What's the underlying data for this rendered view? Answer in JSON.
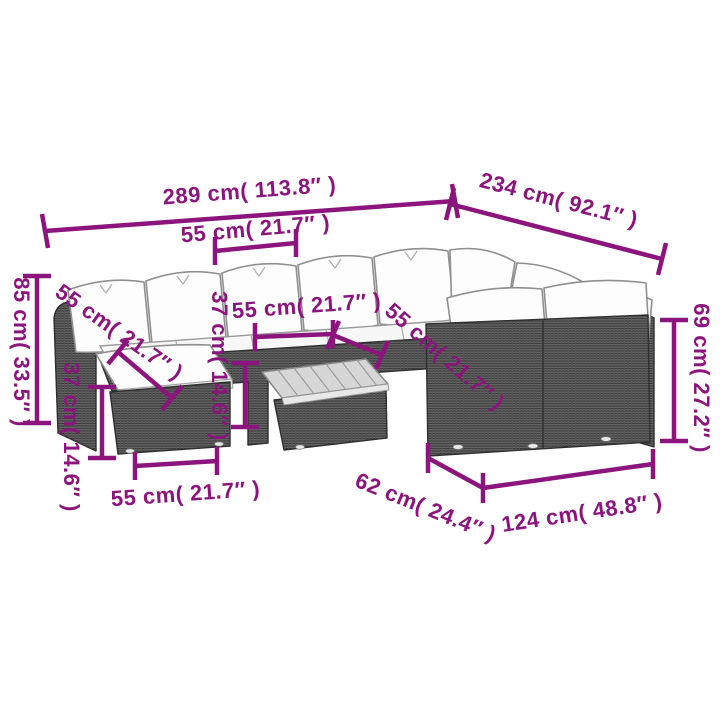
{
  "diagram": {
    "type": "product-dimension-diagram",
    "subject": "rattan garden lounge set with cushions, footstool and coffee table",
    "unit_system": "cm and inches"
  },
  "colors": {
    "dimension_accent": "#8C147D",
    "rattan_gray": "#666666",
    "cushion_white": "#fdfdfd",
    "background": "#ffffff"
  },
  "dimensions": [
    {
      "id": "total-width",
      "label": "289 cm( 113.8″ )",
      "cm": "289",
      "inches": "113.8"
    },
    {
      "id": "total-depth",
      "label": "234 cm( 92.1″ )",
      "cm": "234",
      "inches": "92.1"
    },
    {
      "id": "seat-width-top",
      "label": "55 cm( 21.7″ )",
      "cm": "55",
      "inches": "21.7"
    },
    {
      "id": "back-height",
      "label": "85 cm( 33.5″ )",
      "cm": "85",
      "inches": "33.5"
    },
    {
      "id": "seat-depth-left",
      "label": "55 cm( 21.7″ )",
      "cm": "55",
      "inches": "21.7"
    },
    {
      "id": "stool-height",
      "label": "37 cm( 14.6″ )",
      "cm": "37",
      "inches": "14.6"
    },
    {
      "id": "seat-width-middle",
      "label": "55 cm( 21.7″ )",
      "cm": "55",
      "inches": "21.7"
    },
    {
      "id": "table-height",
      "label": "37 cm( 14.6″ )",
      "cm": "37",
      "inches": "14.6"
    },
    {
      "id": "seat-width-right",
      "label": "55 cm( 21.7″ )",
      "cm": "55",
      "inches": "21.7"
    },
    {
      "id": "sofa-height-right",
      "label": "69 cm( 27.2″ )",
      "cm": "69",
      "inches": "27.2"
    },
    {
      "id": "stool-width",
      "label": "55 cm( 21.7″ )",
      "cm": "55",
      "inches": "21.7"
    },
    {
      "id": "table-width",
      "label": "62 cm( 24.4″ )",
      "cm": "62",
      "inches": "24.4"
    },
    {
      "id": "two-seater-width",
      "label": "124 cm( 48.8″ )",
      "cm": "124",
      "inches": "48.8"
    }
  ]
}
